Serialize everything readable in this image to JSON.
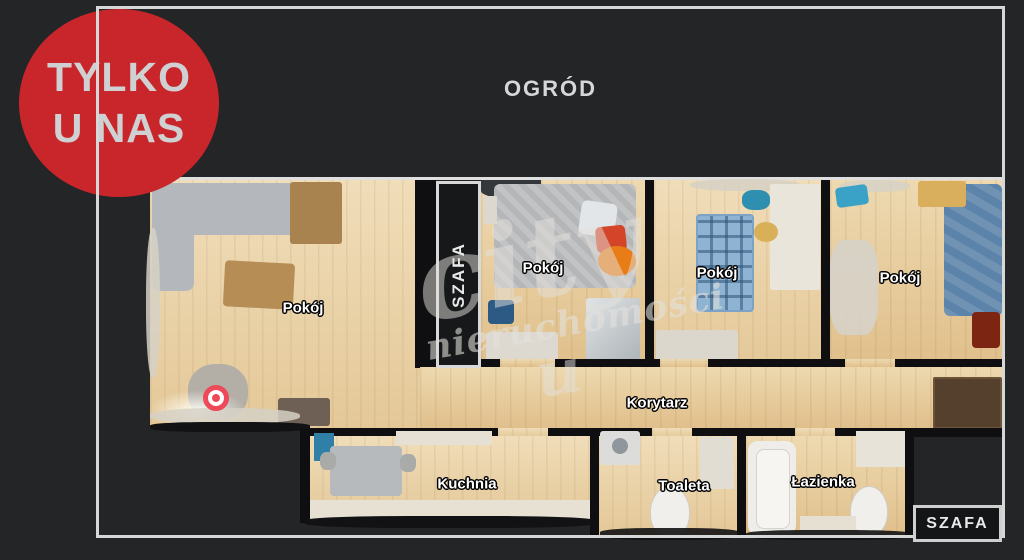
{
  "badge": {
    "line1": "TYLKO",
    "line2": "U NAS",
    "color": "#c9262c"
  },
  "garden": {
    "label": "OGRÓD"
  },
  "watermark": {
    "brand": "city",
    "word": "nieruchomości",
    "flourish": "u"
  },
  "rooms": {
    "living": "Pokój",
    "bedroom": "Pokój",
    "kids": "Pokój",
    "right": "Pokój",
    "corridor": "Korytarz",
    "kitchen": "Kuchnia",
    "toilet": "Toaleta",
    "bathroom": "Łazienka",
    "wardrobe_strip": "SZAFA",
    "wardrobe_box": "SZAFA"
  },
  "colors": {
    "accent_red": "#c9262c",
    "frame": "#d6d7d7",
    "marker_red": "#ee4958",
    "background": "#232526"
  }
}
